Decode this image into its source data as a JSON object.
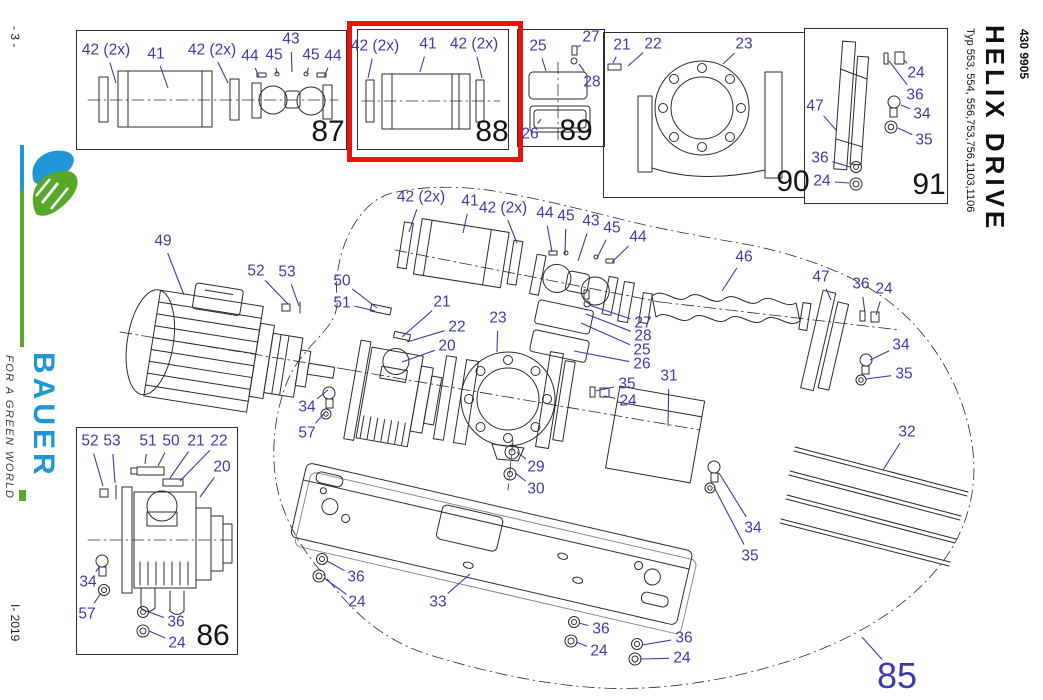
{
  "meta": {
    "page_number": "- 3 -",
    "issue_code": "I- 2019"
  },
  "brand": {
    "name": "BAUER",
    "tagline": "FOR A GREEN WORLD",
    "blue": "#1f96d5",
    "green": "#57a829"
  },
  "title_block": {
    "doc_number": "430 9905",
    "title": "HELIX DRIVE",
    "types": "Typ 553, 554, 556,753,756,1103,1106"
  },
  "colors": {
    "callout": "#3b3baa",
    "highlight": "#e8130d",
    "drawing": "#2b2b2b"
  },
  "inset_boxes": [
    {
      "id": "87",
      "x": 76,
      "y": 30,
      "w": 269,
      "h": 118,
      "parts": [
        "42 (2x)",
        "41",
        "42 (2x)",
        "44",
        "45",
        "43",
        "45",
        "44"
      ]
    },
    {
      "id": "88",
      "x": 357,
      "y": 29,
      "w": 150,
      "h": 119,
      "parts": [
        "42 (2x)",
        "41",
        "42 (2x)"
      ],
      "highlighted": true
    },
    {
      "id": "89",
      "x": 517,
      "y": 29,
      "w": 86,
      "h": 116,
      "parts": [
        "25",
        "27",
        "28",
        "26"
      ]
    },
    {
      "id": "90",
      "x": 603,
      "y": 32,
      "w": 200,
      "h": 164,
      "parts": [
        "21",
        "22",
        "23"
      ]
    },
    {
      "id": "91",
      "x": 804,
      "y": 28,
      "w": 142,
      "h": 174,
      "parts": [
        "24",
        "36",
        "47",
        "34",
        "35",
        "36",
        "24"
      ]
    },
    {
      "id": "86",
      "x": 76,
      "y": 427,
      "w": 160,
      "h": 226,
      "parts": [
        "52",
        "53",
        "51",
        "50",
        "21",
        "22",
        "20",
        "34",
        "57",
        "36",
        "24"
      ]
    }
  ],
  "highlight_frame": {
    "x": 347,
    "y": 21,
    "w": 166,
    "h": 131,
    "highlights": "88"
  },
  "inset_numbers": [
    {
      "t": "87",
      "x": 328,
      "y": 132
    },
    {
      "t": "88",
      "x": 492,
      "y": 132
    },
    {
      "t": "89",
      "x": 576,
      "y": 131
    },
    {
      "t": "90",
      "x": 793,
      "y": 182
    },
    {
      "t": "91",
      "x": 929,
      "y": 185
    },
    {
      "t": "86",
      "x": 213,
      "y": 636
    }
  ],
  "callouts": [
    {
      "t": "42 (2x)",
      "x": 106,
      "y": 50,
      "lx": 116,
      "ly": 83
    },
    {
      "t": "41",
      "x": 156,
      "y": 54,
      "lx": 168,
      "ly": 88
    },
    {
      "t": "42 (2x)",
      "x": 212,
      "y": 50,
      "lx": 228,
      "ly": 83
    },
    {
      "t": "44",
      "x": 250,
      "y": 56,
      "lx": 259,
      "ly": 77
    },
    {
      "t": "45",
      "x": 274,
      "y": 55,
      "lx": 277,
      "ly": 74
    },
    {
      "t": "43",
      "x": 291,
      "y": 39,
      "lx": 292,
      "ly": 72
    },
    {
      "t": "45",
      "x": 311,
      "y": 55,
      "lx": 307,
      "ly": 74
    },
    {
      "t": "44",
      "x": 333,
      "y": 56,
      "lx": 324,
      "ly": 77
    },
    {
      "t": "42 (2x)",
      "x": 375,
      "y": 46,
      "lx": 368,
      "ly": 78
    },
    {
      "t": "41",
      "x": 428,
      "y": 44,
      "lx": 420,
      "ly": 72
    },
    {
      "t": "42 (2x)",
      "x": 474,
      "y": 44,
      "lx": 482,
      "ly": 78
    },
    {
      "t": "25",
      "x": 538,
      "y": 46,
      "lx": 546,
      "ly": 71
    },
    {
      "t": "27",
      "x": 591,
      "y": 37,
      "lx": 578,
      "ly": 47
    },
    {
      "t": "28",
      "x": 592,
      "y": 82,
      "lx": 579,
      "ly": 64
    },
    {
      "t": "26",
      "x": 530,
      "y": 134,
      "lx": 541,
      "ly": 119
    },
    {
      "t": "21",
      "x": 622,
      "y": 45,
      "lx": 613,
      "ly": 63
    },
    {
      "t": "22",
      "x": 653,
      "y": 44,
      "lx": 628,
      "ly": 66
    },
    {
      "t": "23",
      "x": 744,
      "y": 44,
      "lx": 723,
      "ly": 64
    },
    {
      "t": "24",
      "x": 916,
      "y": 73,
      "lx": 904,
      "ly": 60
    },
    {
      "t": "36",
      "x": 915,
      "y": 95,
      "lx": 889,
      "ly": 61
    },
    {
      "t": "47",
      "x": 815,
      "y": 106,
      "lx": 836,
      "ly": 130
    },
    {
      "t": "34",
      "x": 922,
      "y": 114,
      "lx": 901,
      "ly": 105
    },
    {
      "t": "35",
      "x": 924,
      "y": 140,
      "lx": 898,
      "ly": 128
    },
    {
      "t": "36",
      "x": 820,
      "y": 158,
      "lx": 850,
      "ly": 167
    },
    {
      "t": "24",
      "x": 822,
      "y": 181,
      "lx": 849,
      "ly": 183
    },
    {
      "t": "52",
      "x": 90,
      "y": 441,
      "lx": 103,
      "ly": 486
    },
    {
      "t": "53",
      "x": 112,
      "y": 441,
      "lx": 115,
      "ly": 483
    },
    {
      "t": "51",
      "x": 148,
      "y": 441,
      "lx": 145,
      "ly": 464
    },
    {
      "t": "50",
      "x": 171,
      "y": 441,
      "lx": 158,
      "ly": 466
    },
    {
      "t": "21",
      "x": 196,
      "y": 441,
      "lx": 170,
      "ly": 478
    },
    {
      "t": "22",
      "x": 219,
      "y": 441,
      "lx": 180,
      "ly": 481
    },
    {
      "t": "20",
      "x": 222,
      "y": 467,
      "lx": 200,
      "ly": 497
    },
    {
      "t": "34",
      "x": 88,
      "y": 582,
      "lx": 100,
      "ly": 566
    },
    {
      "t": "57",
      "x": 87,
      "y": 614,
      "lx": 101,
      "ly": 593
    },
    {
      "t": "36",
      "x": 176,
      "y": 622,
      "lx": 149,
      "ly": 612
    },
    {
      "t": "24",
      "x": 177,
      "y": 643,
      "lx": 149,
      "ly": 631
    },
    {
      "t": "42 (2x)",
      "x": 421,
      "y": 197,
      "lx": 409,
      "ly": 232
    },
    {
      "t": "41",
      "x": 470,
      "y": 201,
      "lx": 463,
      "ly": 233
    },
    {
      "t": "42 (2x)",
      "x": 503,
      "y": 208,
      "lx": 517,
      "ly": 243
    },
    {
      "t": "44",
      "x": 545,
      "y": 213,
      "lx": 552,
      "ly": 252
    },
    {
      "t": "45",
      "x": 566,
      "y": 216,
      "lx": 565,
      "ly": 254
    },
    {
      "t": "43",
      "x": 591,
      "y": 221,
      "lx": 578,
      "ly": 261
    },
    {
      "t": "45",
      "x": 612,
      "y": 228,
      "lx": 597,
      "ly": 258
    },
    {
      "t": "44",
      "x": 638,
      "y": 237,
      "lx": 612,
      "ly": 262
    },
    {
      "t": "46",
      "x": 744,
      "y": 257,
      "lx": 722,
      "ly": 291
    },
    {
      "t": "47",
      "x": 821,
      "y": 277,
      "lx": 831,
      "ly": 300
    },
    {
      "t": "36",
      "x": 861,
      "y": 284,
      "lx": 865,
      "ly": 313
    },
    {
      "t": "24",
      "x": 884,
      "y": 289,
      "lx": 876,
      "ly": 315
    },
    {
      "t": "49",
      "x": 163,
      "y": 241,
      "lx": 184,
      "ly": 295
    },
    {
      "t": "52",
      "x": 256,
      "y": 271,
      "lx": 288,
      "ly": 304
    },
    {
      "t": "53",
      "x": 287,
      "y": 272,
      "lx": 299,
      "ly": 306
    },
    {
      "t": "50",
      "x": 342,
      "y": 281,
      "lx": 377,
      "ly": 308
    },
    {
      "t": "51",
      "x": 342,
      "y": 303,
      "lx": 375,
      "ly": 311
    },
    {
      "t": "21",
      "x": 442,
      "y": 302,
      "lx": 402,
      "ly": 337
    },
    {
      "t": "22",
      "x": 457,
      "y": 327,
      "lx": 407,
      "ly": 342
    },
    {
      "t": "20",
      "x": 447,
      "y": 346,
      "lx": 402,
      "ly": 362
    },
    {
      "t": "23",
      "x": 498,
      "y": 318,
      "lx": 497,
      "ly": 352
    },
    {
      "t": "27",
      "x": 643,
      "y": 323,
      "lx": 589,
      "ly": 305
    },
    {
      "t": "28",
      "x": 643,
      "y": 336,
      "lx": 586,
      "ly": 314
    },
    {
      "t": "25",
      "x": 642,
      "y": 350,
      "lx": 581,
      "ly": 323
    },
    {
      "t": "26",
      "x": 642,
      "y": 364,
      "lx": 574,
      "ly": 351
    },
    {
      "t": "31",
      "x": 669,
      "y": 376,
      "lx": 668,
      "ly": 426
    },
    {
      "t": "35",
      "x": 627,
      "y": 384,
      "lx": 596,
      "ly": 391
    },
    {
      "t": "24",
      "x": 628,
      "y": 401,
      "lx": 604,
      "ly": 396
    },
    {
      "t": "34",
      "x": 307,
      "y": 407,
      "lx": 328,
      "ly": 390
    },
    {
      "t": "57",
      "x": 307,
      "y": 433,
      "lx": 326,
      "ly": 411
    },
    {
      "t": "29",
      "x": 536,
      "y": 467,
      "lx": 517,
      "ly": 452
    },
    {
      "t": "30",
      "x": 536,
      "y": 489,
      "lx": 515,
      "ly": 473
    },
    {
      "t": "32",
      "x": 907,
      "y": 432,
      "lx": 883,
      "ly": 470
    },
    {
      "t": "34",
      "x": 901,
      "y": 345,
      "lx": 870,
      "ly": 360
    },
    {
      "t": "35",
      "x": 904,
      "y": 374,
      "lx": 866,
      "ly": 379
    },
    {
      "t": "34",
      "x": 753,
      "y": 528,
      "lx": 719,
      "ly": 473
    },
    {
      "t": "35",
      "x": 750,
      "y": 556,
      "lx": 714,
      "ly": 487
    },
    {
      "t": "36",
      "x": 356,
      "y": 577,
      "lx": 327,
      "ly": 561
    },
    {
      "t": "24",
      "x": 357,
      "y": 602,
      "lx": 324,
      "ly": 578
    },
    {
      "t": "33",
      "x": 438,
      "y": 602,
      "lx": 470,
      "ly": 574
    },
    {
      "t": "36",
      "x": 601,
      "y": 629,
      "lx": 579,
      "ly": 623
    },
    {
      "t": "24",
      "x": 599,
      "y": 651,
      "lx": 576,
      "ly": 642
    },
    {
      "t": "36",
      "x": 684,
      "y": 638,
      "lx": 642,
      "ly": 645
    },
    {
      "t": "24",
      "x": 682,
      "y": 658,
      "lx": 640,
      "ly": 659
    },
    {
      "t": "85",
      "x": 897,
      "y": 676,
      "lx": 862,
      "ly": 637,
      "big": true
    }
  ]
}
